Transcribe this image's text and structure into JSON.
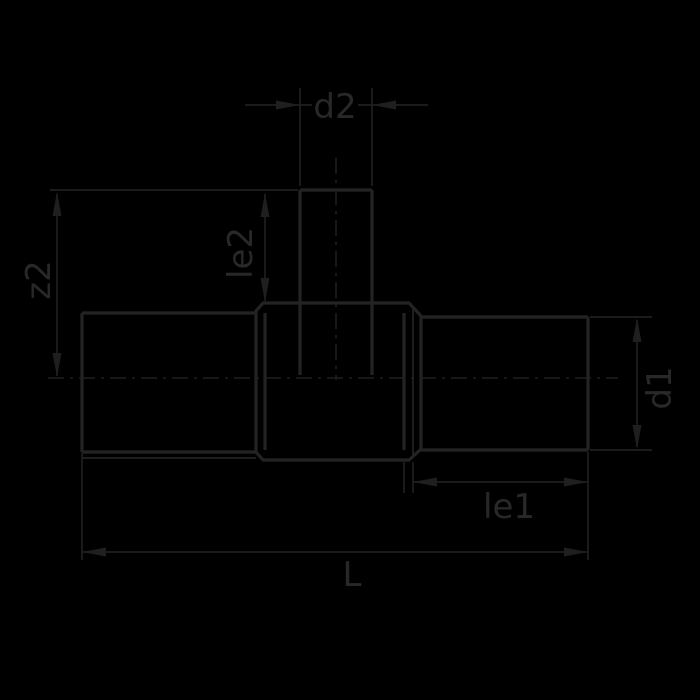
{
  "drawing": {
    "background_color": "#000000",
    "outline_color": "#232323",
    "dimension_color": "#1f1f1f",
    "text_color": "#282828",
    "dimensions": {
      "d2": "d2",
      "le2": "le2",
      "z2": "z2",
      "d1": "d1",
      "le1": "le1",
      "L": "L"
    }
  }
}
